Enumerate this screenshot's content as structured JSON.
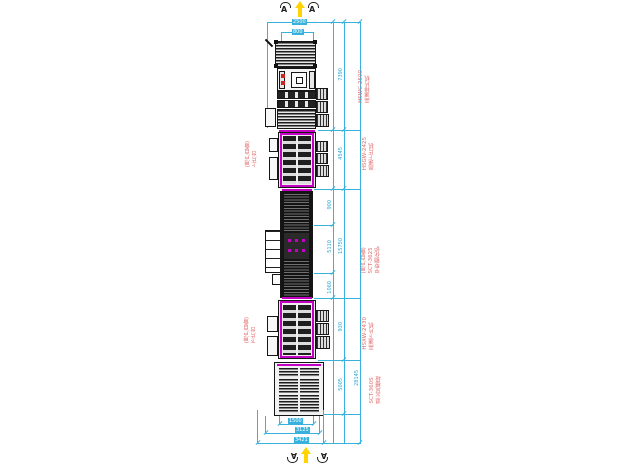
{
  "markers": {
    "top_left": "A",
    "top_right": "A",
    "bottom_left": "A",
    "bottom_right": "A"
  },
  "labels": {
    "m1": {
      "model": "HSWC-2500",
      "name": "高速排片机"
    },
    "m2": {
      "model": "HSGW-2425",
      "name": "高速上片机"
    },
    "m2_left": {
      "line1": "(用户自备)",
      "line2": "上片台"
    },
    "furnace": {
      "note": "(用户自备)",
      "model": "SCT-3625",
      "name": "平型钢化炉"
    },
    "m4": {
      "model": "HSXW-2430",
      "name": "高速下片机"
    },
    "m4_left": {
      "line1": "(用户自备)",
      "line2": "下片台"
    },
    "m5": {
      "model": "SCT-360S",
      "name": "退火风栅段"
    }
  },
  "dims": {
    "top_outer": "2500",
    "top_inner": "800",
    "m1_zone": "7390",
    "m2_zone": "4545",
    "f_seg1": "900",
    "f_seg2": "5110",
    "f_seg3": "1060",
    "f_total": "15750",
    "m4_zone": "930",
    "m5_zone": "5005",
    "overall": "28145",
    "bottom_inner": "1500",
    "bottom_mid": "3125",
    "bottom_outer": "3421"
  },
  "colors": {
    "dimension": "#38b2dc",
    "transfer": "#c400c4",
    "label": "#e06b6b",
    "arrow": "#ffd400"
  }
}
